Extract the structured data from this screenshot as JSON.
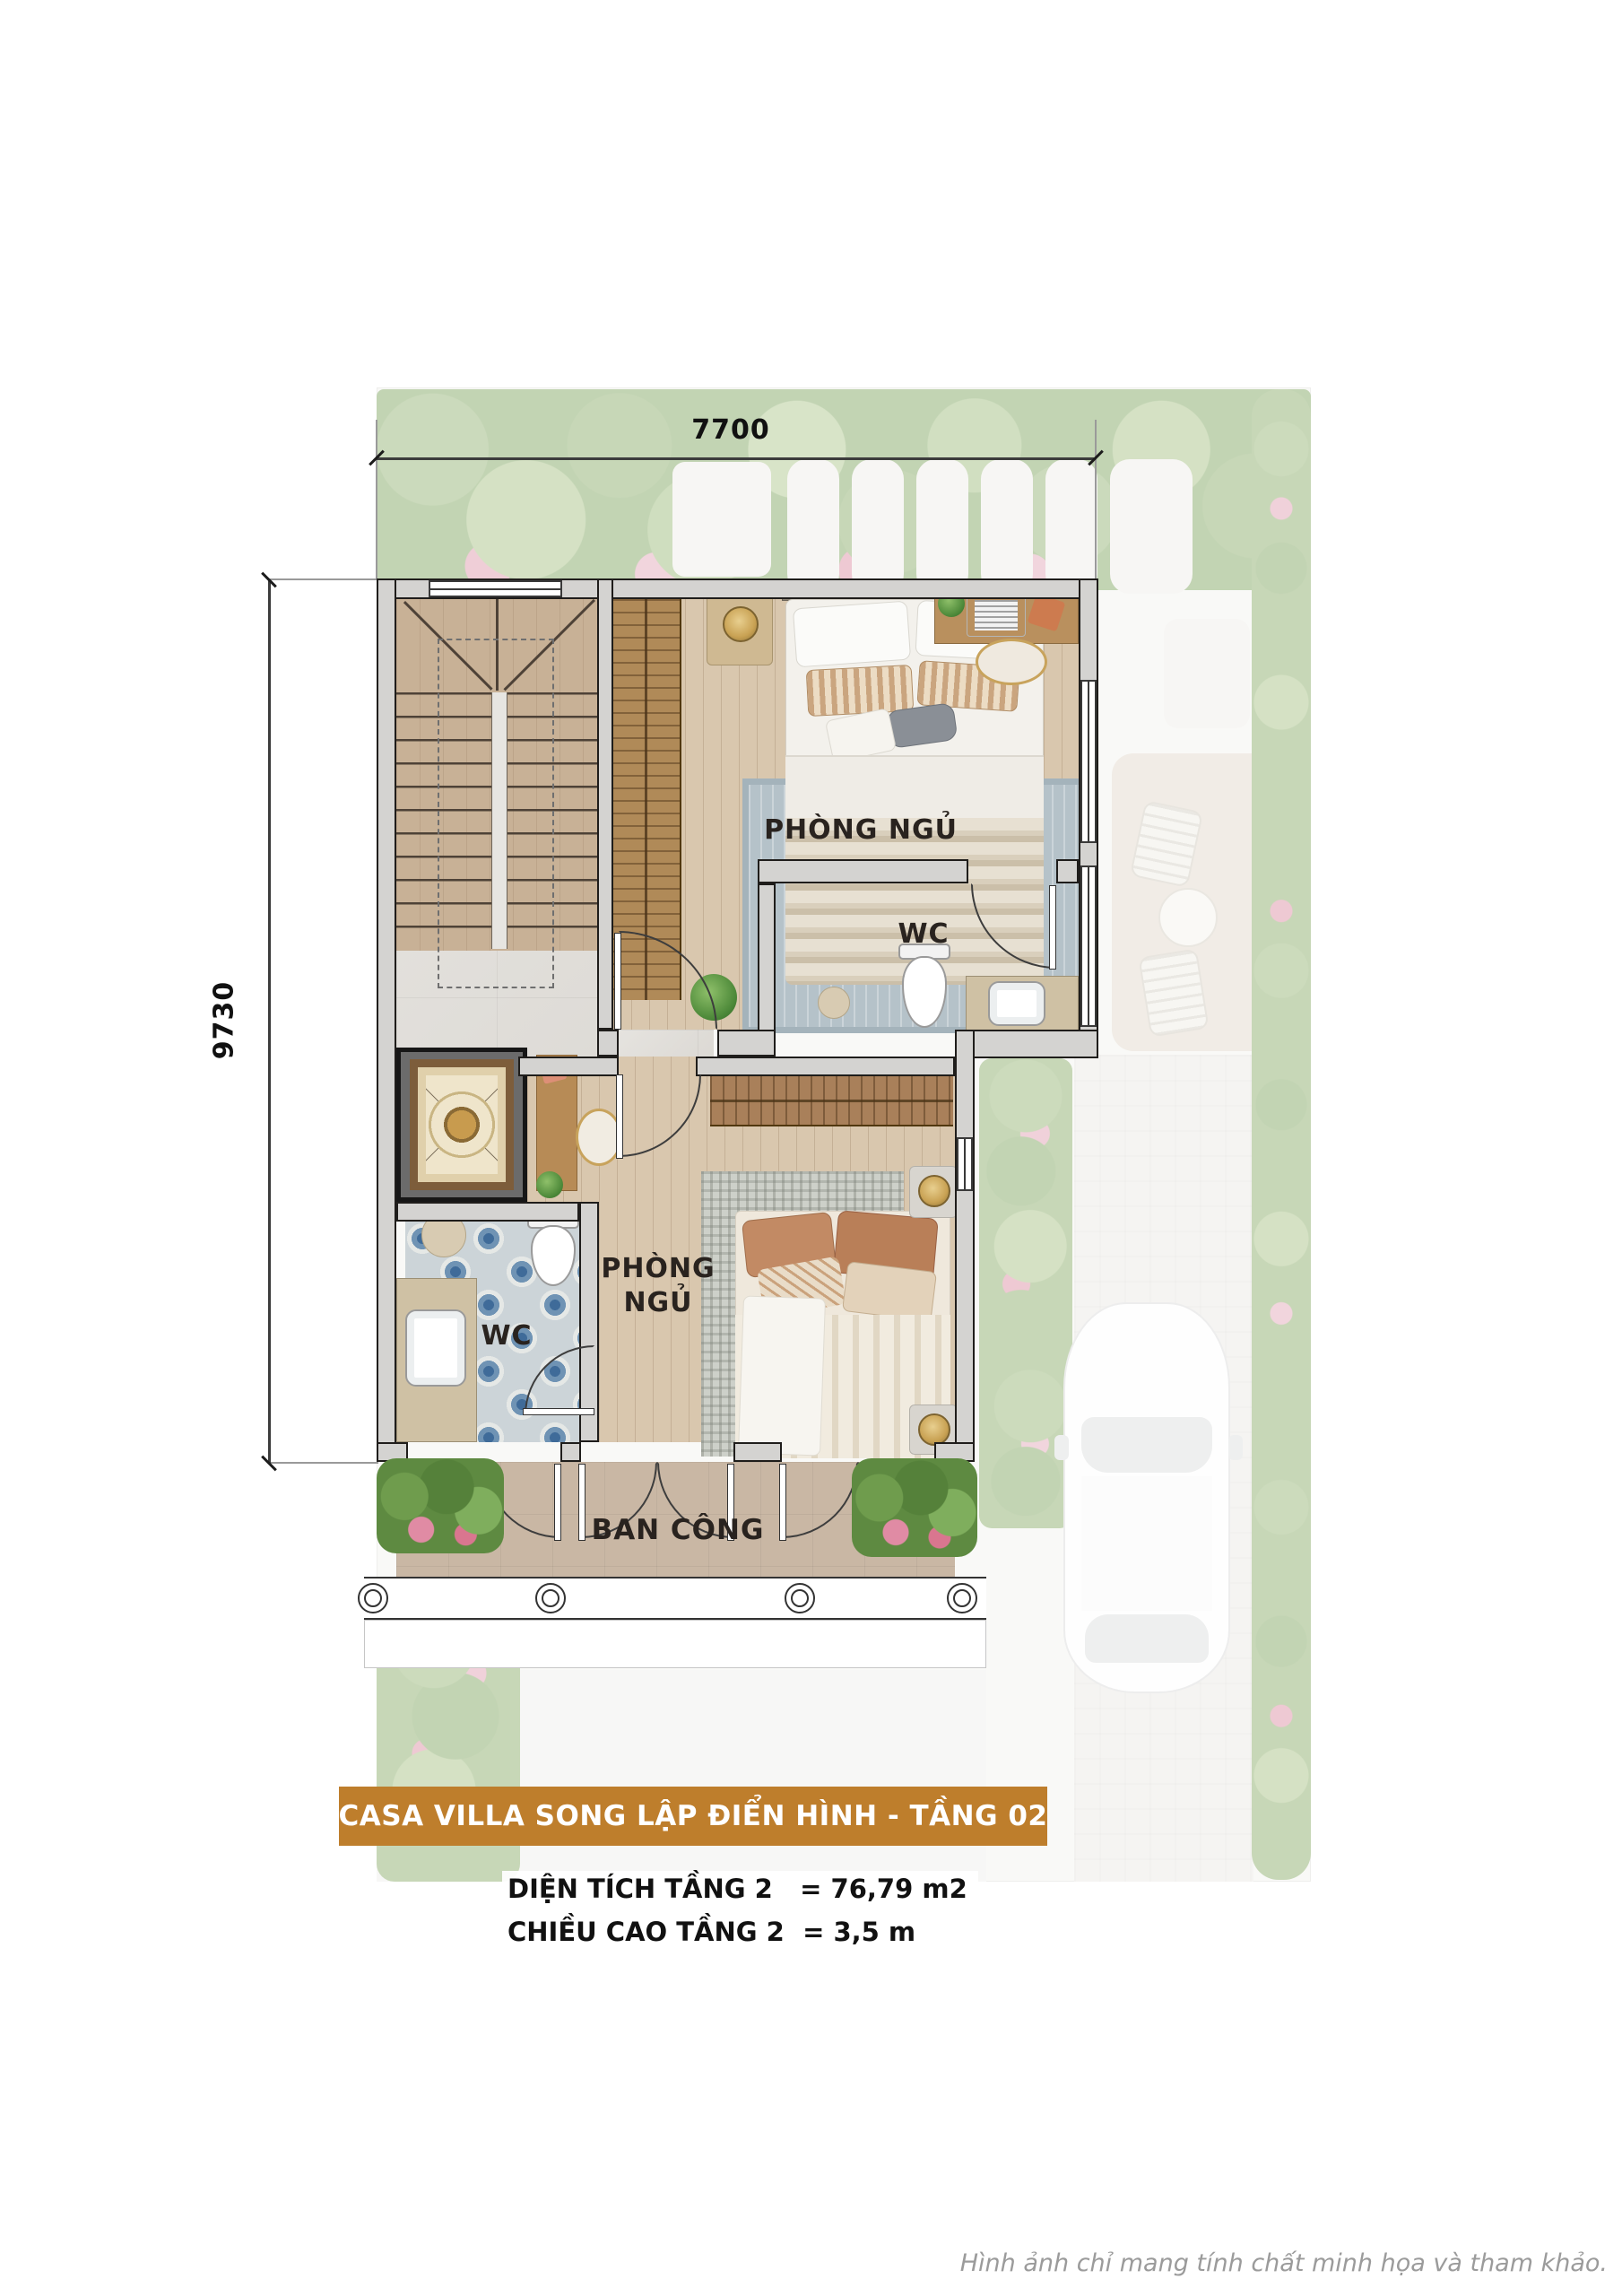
{
  "dimensions": {
    "width": "7700",
    "height": "9730"
  },
  "rooms": {
    "bedroom1": "PHÒNG NGỦ",
    "wc1": "WC",
    "bedroom2": "PHÒNG NGỦ",
    "wc2": "WC",
    "balcony": "BAN CÔNG"
  },
  "footer": {
    "banner": "CASA VILLA SONG LẬP ĐIỂN HÌNH - TẦNG 02",
    "specs": [
      {
        "label": "DIỆN TÍCH TẦNG 2",
        "value": "= 76,79 m2"
      },
      {
        "label": "CHIỀU CAO TẦNG 2",
        "value": "= 3,5 m"
      }
    ],
    "disclaimer": "Hình ảnh chỉ mang tính chất minh họa và tham khảo."
  },
  "colors": {
    "banner_bg": "#BE7E2C",
    "wall_line": "#1f1d1b",
    "tile_blue": "#3f6b99",
    "wood_floor": "#d9c7ae",
    "balcony_floor": "#c9b7a4"
  }
}
